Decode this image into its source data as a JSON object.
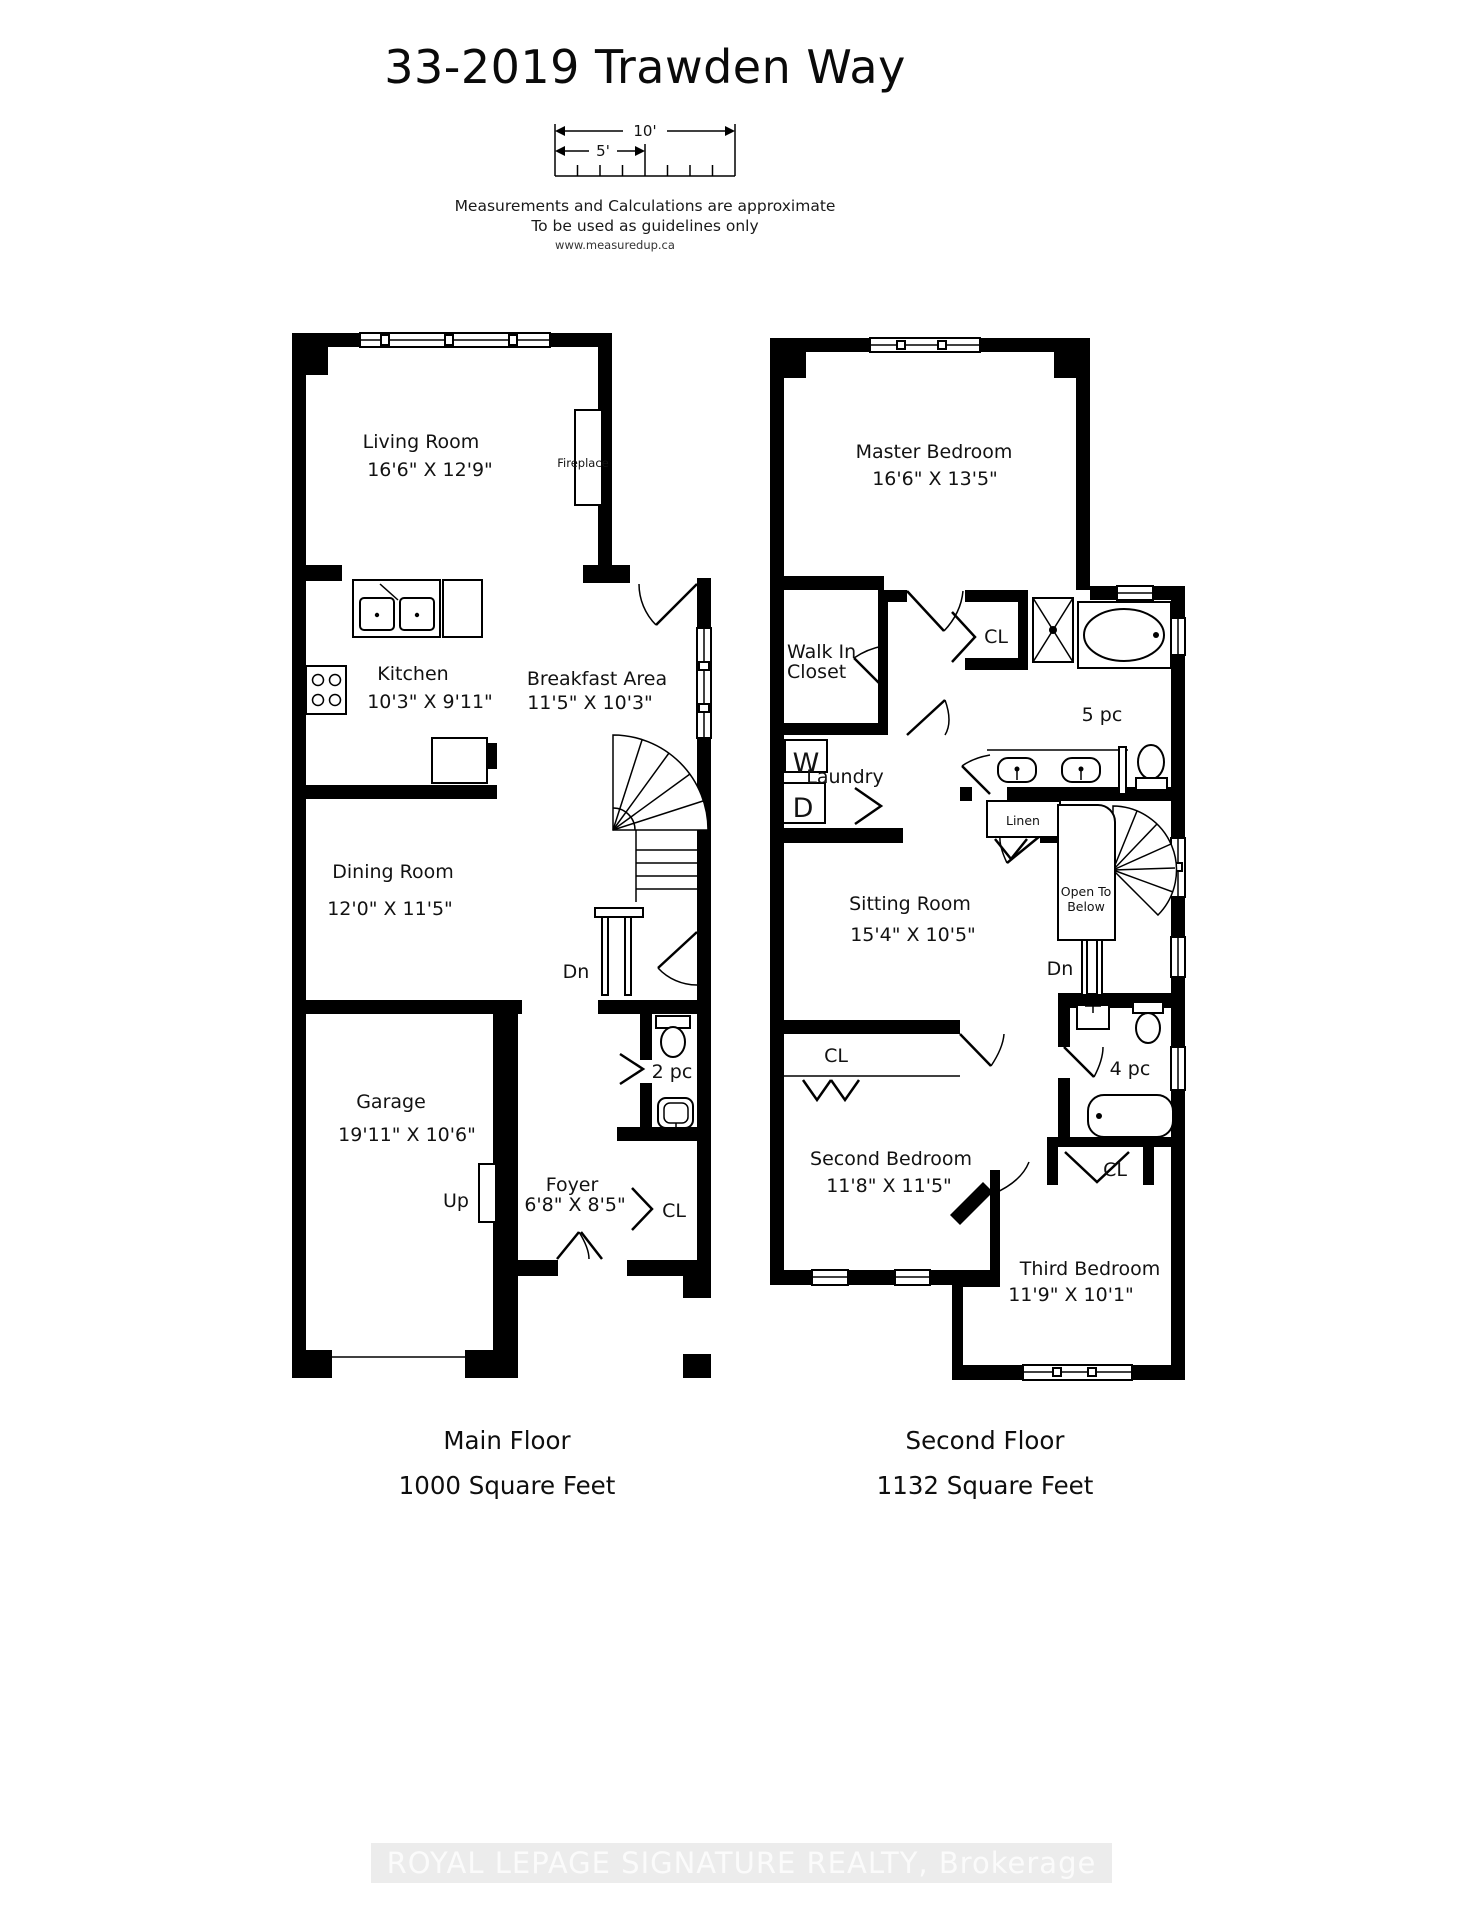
{
  "header": {
    "title": "33-2019 Trawden Way",
    "scale_10": "10'",
    "scale_5": "5'",
    "disclaimer_line1": "Measurements and Calculations are approximate",
    "disclaimer_line2": "To be used as guidelines only",
    "website": "www.measuredup.ca"
  },
  "main_floor": {
    "caption_line1": "Main Floor",
    "caption_line2": "1000 Square Feet",
    "rooms": {
      "living": {
        "name": "Living Room",
        "dims": "16'6\" X 12'9\""
      },
      "kitchen": {
        "name": "Kitchen",
        "dims": "10'3\" X 9'11\""
      },
      "breakfast": {
        "name": "Breakfast Area",
        "dims": "11'5\" X 10'3\""
      },
      "dining": {
        "name": "Dining Room",
        "dims": "12'0\" X 11'5\""
      },
      "garage": {
        "name": "Garage",
        "dims": "19'11\" X 10'6\""
      },
      "foyer": {
        "name": "Foyer",
        "dims": "6'8\" X 8'5\""
      }
    },
    "labels": {
      "fireplace": "Fireplace",
      "dn": "Dn",
      "up": "Up",
      "bath2": "2 pc",
      "closet": "CL"
    }
  },
  "second_floor": {
    "caption_line1": "Second Floor",
    "caption_line2": "1132 Square Feet",
    "rooms": {
      "master": {
        "name": "Master Bedroom",
        "dims": "16'6\" X 13'5\""
      },
      "sitting": {
        "name": "Sitting Room",
        "dims": "15'4\" X 10'5\""
      },
      "second": {
        "name": "Second Bedroom",
        "dims": "11'8\" X 11'5\""
      },
      "third": {
        "name": "Third Bedroom",
        "dims": "11'9\" X 10'1\""
      }
    },
    "labels": {
      "wic1": "Walk In",
      "wic2": "Closet",
      "cl_master": "CL",
      "bath5": "5 pc",
      "washer": "W",
      "dryer": "D",
      "laundry": "Laundry",
      "linen": "Linen",
      "open1": "Open To",
      "open2": "Below",
      "dn": "Dn",
      "bath4": "4 pc",
      "cl_second": "CL",
      "cl_third": "CL"
    }
  },
  "footer": {
    "watermark": "ROYAL LEPAGE SIGNATURE REALTY, Brokerage"
  },
  "colors": {
    "ink": "#000000",
    "watermark_bg": "#ececec",
    "watermark_text": "#fbfbfb"
  }
}
